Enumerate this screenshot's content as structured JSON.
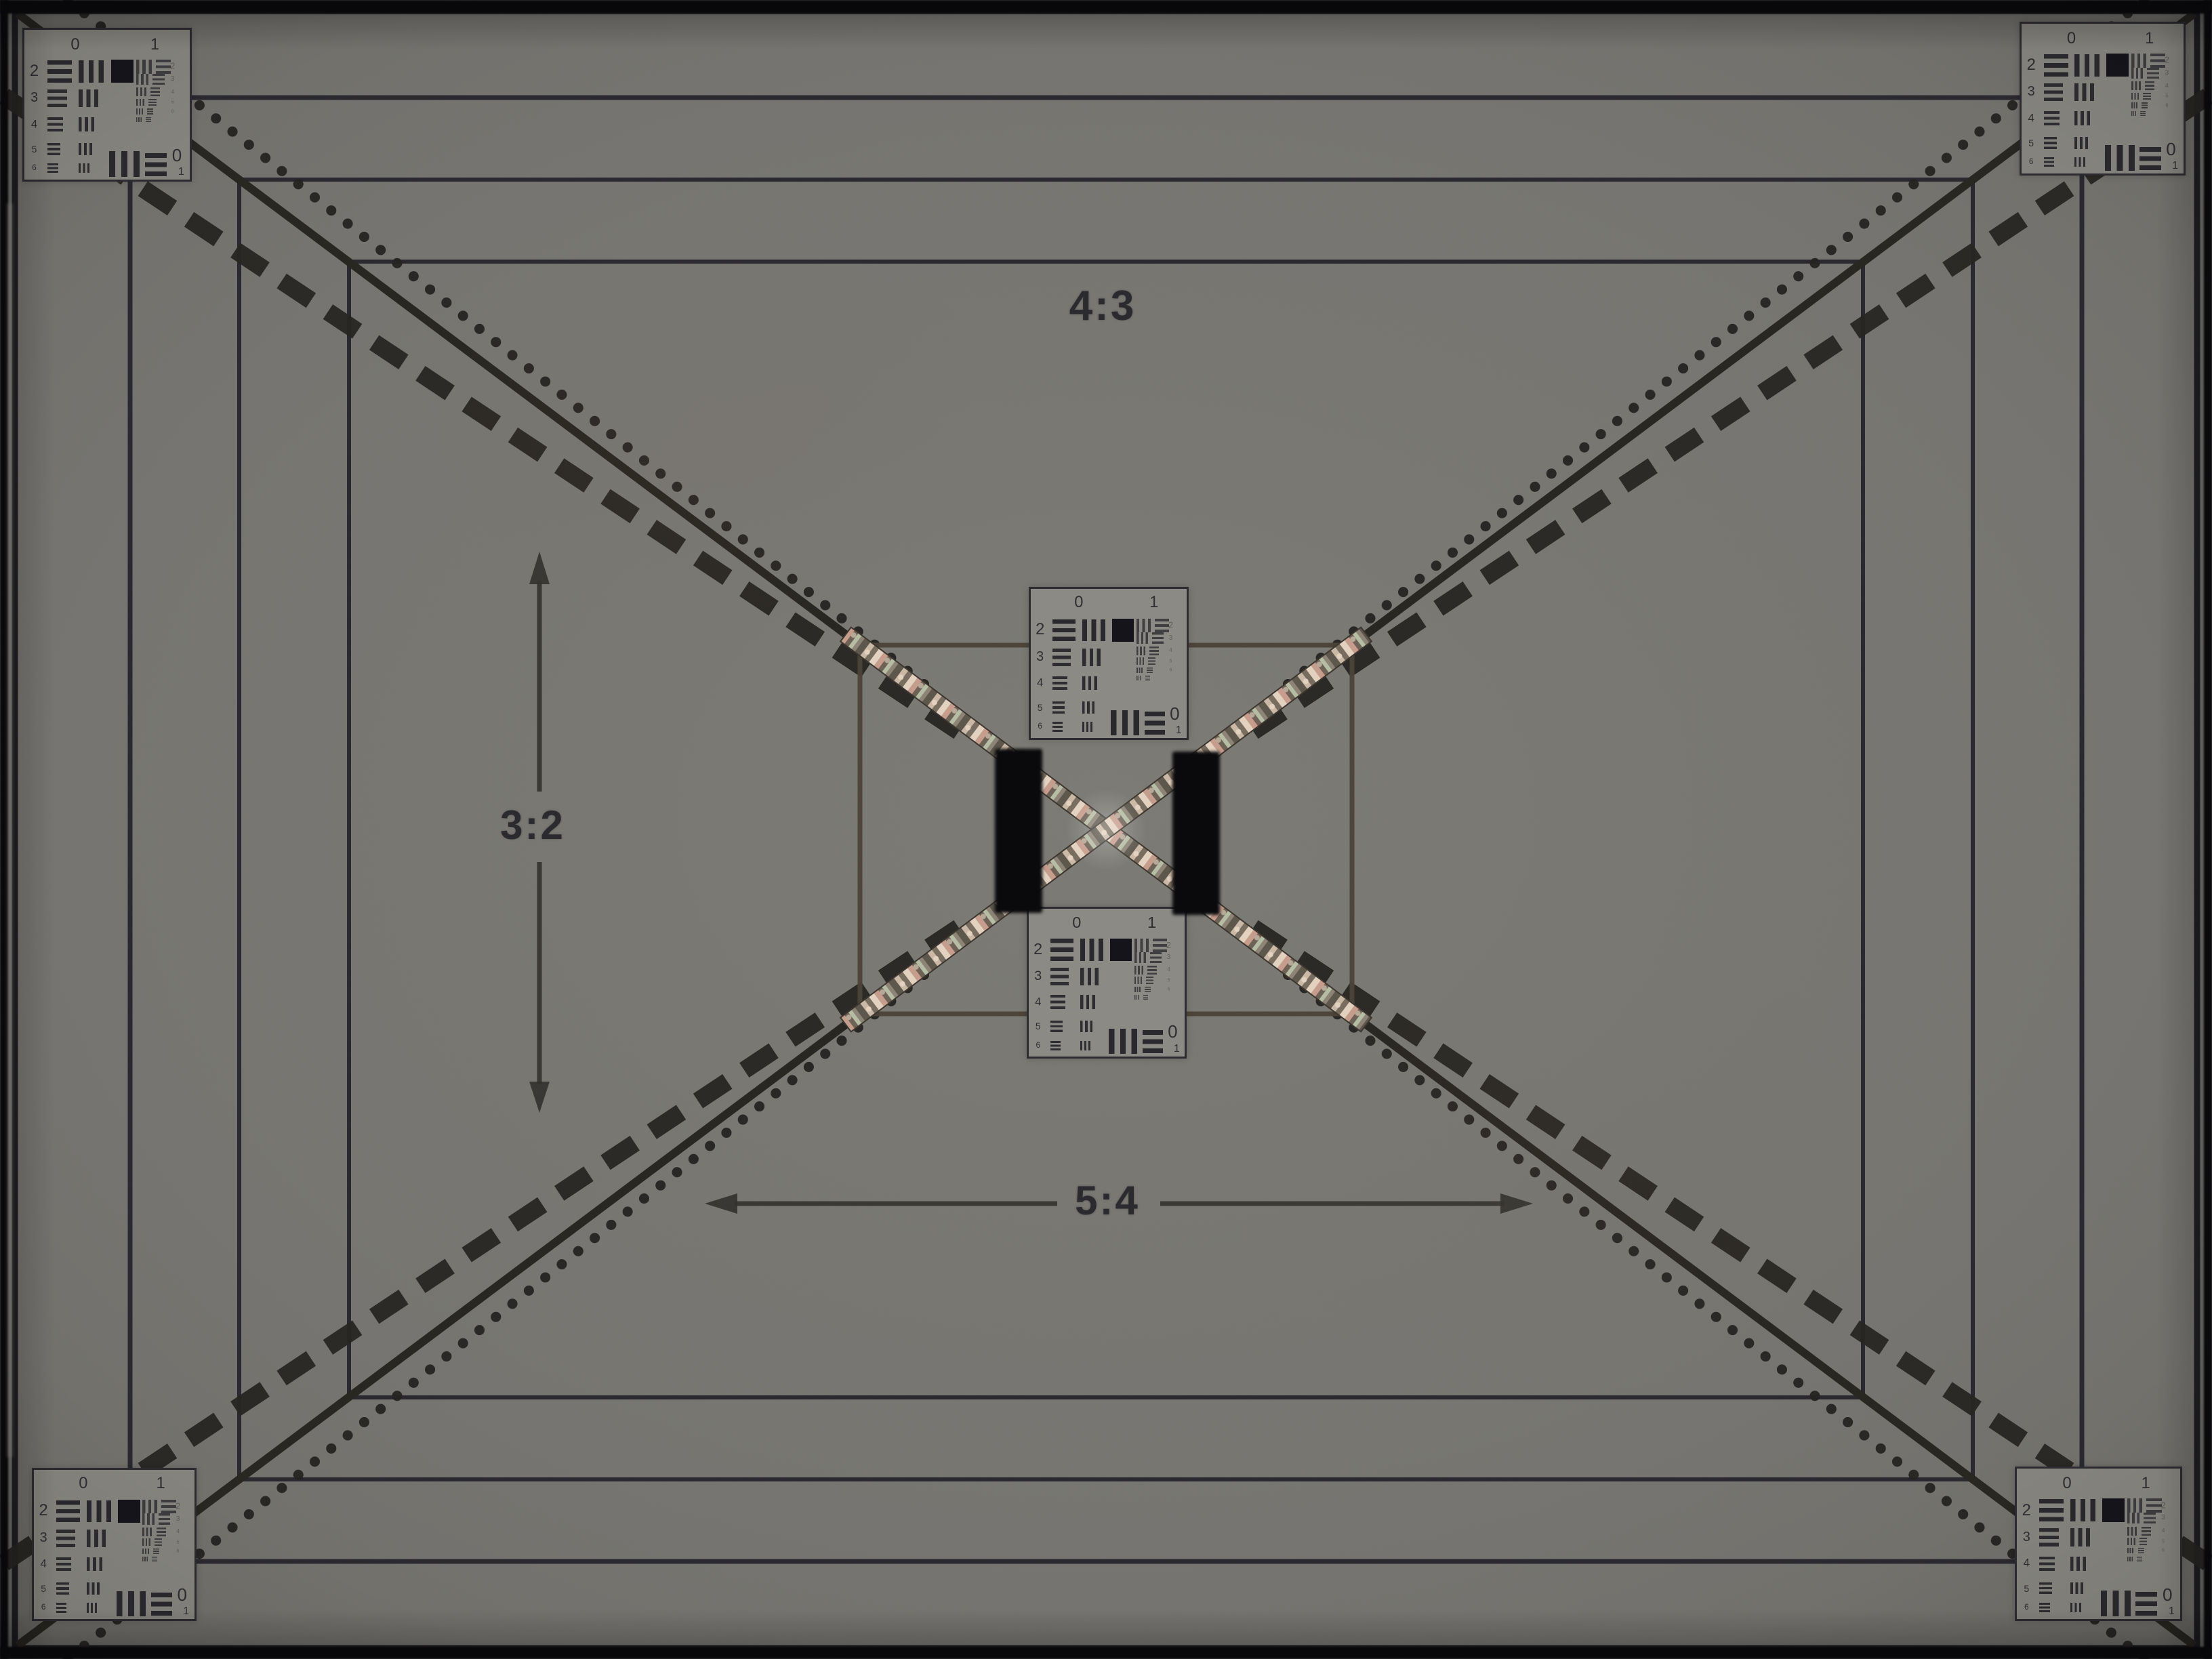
{
  "scene": {
    "title": "resolution-test-chart-photo"
  },
  "labels": {
    "aspect_top": "4:3",
    "aspect_left": "3:2",
    "aspect_bottom": "5:4"
  },
  "resolution_target": {
    "top_digits": [
      "0",
      "1"
    ],
    "row_digits": [
      "2",
      "3",
      "4",
      "5",
      "6"
    ],
    "element_digits": [
      "2",
      "3",
      "4",
      "5",
      "6"
    ],
    "bottom_digits": [
      "0",
      "1"
    ]
  },
  "targets": [
    {
      "id": "corner-top-left"
    },
    {
      "id": "corner-top-right"
    },
    {
      "id": "corner-bottom-left"
    },
    {
      "id": "corner-bottom-right"
    },
    {
      "id": "center-top"
    },
    {
      "id": "center-bottom"
    }
  ],
  "colors": {
    "paper_center": "#7b7a74",
    "paper_edge": "#51504b",
    "line": "#222128",
    "ink": "#2b2a2f",
    "target_bg_corner": "#84837d",
    "target_bg_center": "#8b8a84",
    "bar_color": "#1c1c22",
    "black_bar": "#0a0a0d",
    "black_square": "#14141a",
    "metal_dark": "#5c564b",
    "metal_mid": "#cbb9a6",
    "metal_light": "#e3d2bf",
    "metal_warm": "#c79d8d",
    "metal_green": "#b5bda4",
    "inner_frame": "#4a4136",
    "arrow": "#33312c"
  }
}
